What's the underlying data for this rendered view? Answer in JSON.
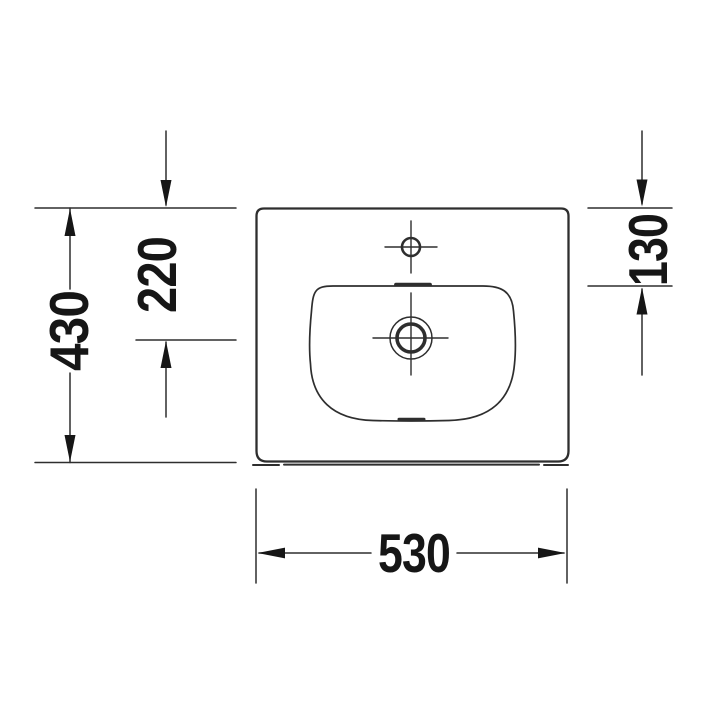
{
  "drawing": {
    "background": "#ffffff",
    "line_color": "#2e2e2e",
    "text_color": "#161616",
    "labels": {
      "overall_width": "530",
      "overall_depth": "430",
      "drain_center_offset": "220",
      "bowl_rim_offset": "130"
    }
  }
}
